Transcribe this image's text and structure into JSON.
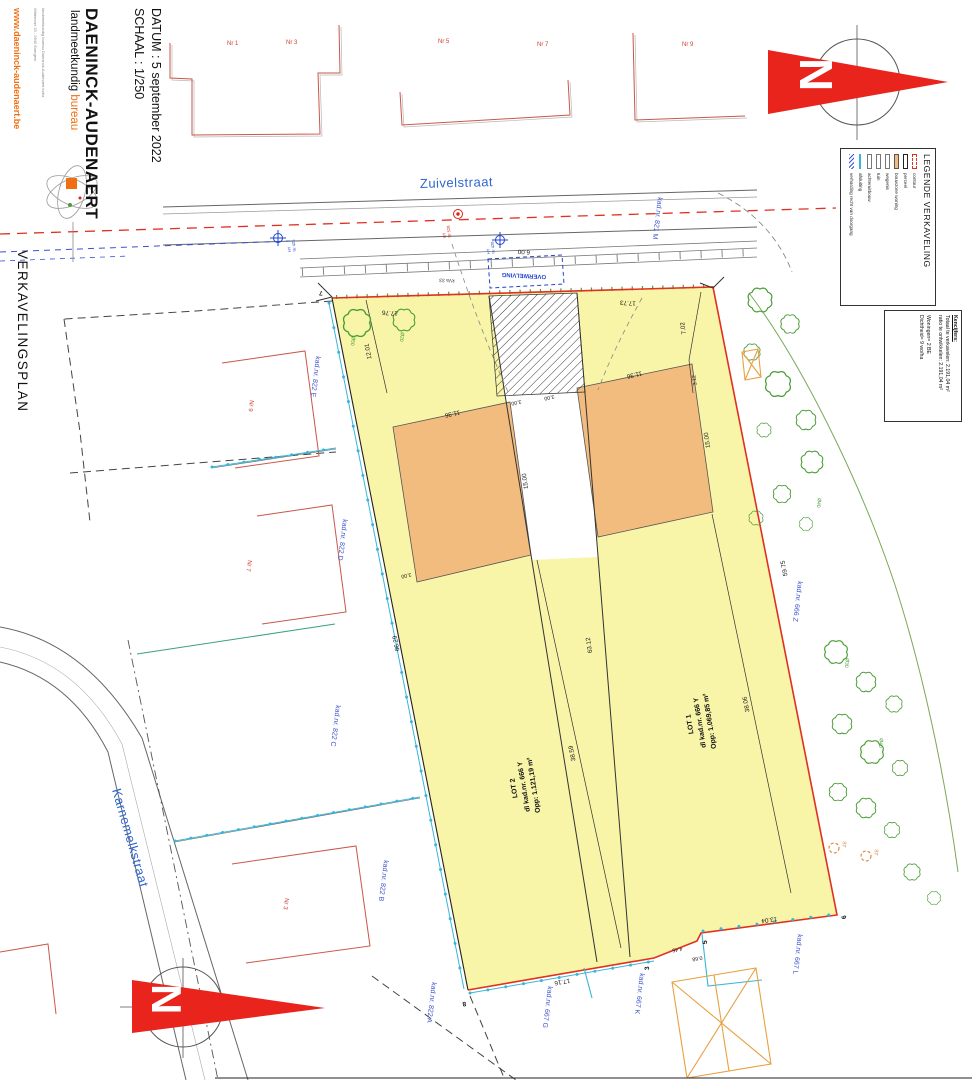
{
  "title_block": {
    "scale": "SCHAAL : 1/250",
    "date": "DATUM : 5 september 2022",
    "firm": "DAENINCK-AUDENAERT",
    "firm_sub1": "landmeetkundig ",
    "firm_sub2": "bureau",
    "address1": "landmeetkundig bureau Daeninck-Audenaert bvba",
    "address2": "Wittemoer 33 - 9940 Evergem",
    "website": "www.daeninck-audenaert.be"
  },
  "plan_title": "VERKAVELINGSPLAN",
  "legend": {
    "title": "LEGENDE VERKAVELING",
    "items": [
      {
        "label": "contour"
      },
      {
        "label": "perceel"
      },
      {
        "label": "bouwzone woning"
      },
      {
        "label": "wegenis"
      },
      {
        "label": "tuin"
      },
      {
        "label": "achteruitbouw"
      },
      {
        "label": "afsluiting"
      },
      {
        "label": "verharding recht van doorgang"
      }
    ]
  },
  "kencijfers": {
    "heading": "Kencijfers:",
    "line1": "Totaal te verkavelen: 2.191,04 m²",
    "line2": "ratio te ontwikkelen: 2.191,04 m²",
    "line3": "Woningen= 2 BE",
    "line4": "Dichtheid= 9 wo/ha"
  },
  "streets": {
    "north": "Zuivelstraat",
    "west": "Karnemelkstraat"
  },
  "lots": {
    "lot1": {
      "name": "LOT 1",
      "parcel": "dl kad.nr. 666 Y",
      "area": "Opp: 1.069,85 m²"
    },
    "lot2": {
      "name": "LOT 2",
      "parcel": "dl kad.nr. 666 Y",
      "area": "Opp: 1.121,19 m²"
    }
  },
  "cadastral": {
    "k822e": "kad.nr. 822 E",
    "k822d": "kad.nr. 822 D",
    "k822c": "kad.nr. 822 C",
    "k822b": "kad.nr. 822 B",
    "k822a": "kad.nr. 822 A",
    "k666z": "kad.nr. 666 Z",
    "k667g": "kad.nr. 667 G",
    "k667k": "kad.nr. 667 K",
    "k667l": "kad.nr. 667 L",
    "k821m": "kad.nr. 821 M"
  },
  "houses": {
    "n1": "Nr 1",
    "n3": "Nr 3",
    "n5": "Nr 5",
    "n7": "Nr 7",
    "n9": "Nr 9",
    "w9": "Nr 9",
    "w7": "Nr 7",
    "w3": "Nr 3"
  },
  "points": {
    "p3": "3",
    "p5": "5",
    "p6": "6",
    "p7": "7",
    "p8": "8"
  },
  "dims": {
    "d1776": "17.76",
    "d1773": "17.73",
    "d600": "6.00",
    "d1201": "12.01",
    "d702": "7.02",
    "d312": "3.12",
    "d300": "3.00",
    "d1136": "11.36",
    "d1500": "15.00",
    "d6629": "66.29",
    "d6312": "63.12",
    "d5975": "59.75",
    "d3806": "38.06",
    "d3859": "38.59",
    "d1716": "17.16",
    "d445": "4.45",
    "d068": "0.68",
    "d1304": "13.04"
  },
  "annotations": {
    "overwelving": "OVERWELVING",
    "kva": "kVa 33",
    "st": "ST",
    "d50": "Ø50",
    "d20": "Ø20",
    "d40": "Ø40",
    "d30": "Ø30"
  },
  "utilities": {
    "hy": "HY",
    "n528": "Nr 528",
    "n428": "Nr 428",
    "n425": "Nr 425"
  },
  "compass": {
    "north": "N"
  },
  "colors": {
    "parcel_yellow": "#f8f4a8",
    "bouwzone_orange": "#f2bc7e",
    "boundary_red": "#e03020",
    "cadastral_blue": "#3a52cc",
    "tree_green": "#4a9e35",
    "fence_cyan": "#38b6d9",
    "brand_orange": "#f07010",
    "north_red": "#e8241c"
  }
}
